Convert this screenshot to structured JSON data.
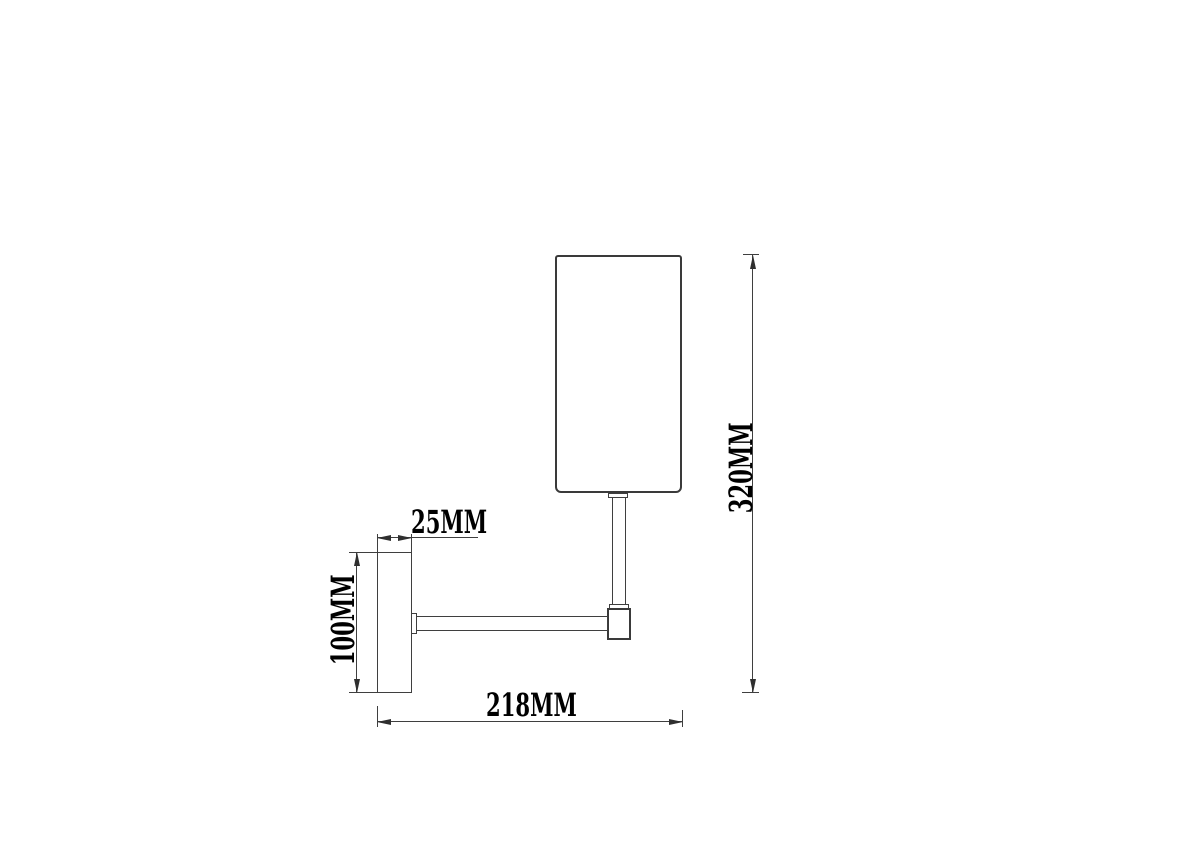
{
  "labels": {
    "plate_depth": "25MM",
    "plate_height": "100MM",
    "projection": "218MM",
    "overall_height": "320MM"
  },
  "colors": {
    "line": "#3f3f3f",
    "text": "#000000",
    "background": "#ffffff"
  }
}
